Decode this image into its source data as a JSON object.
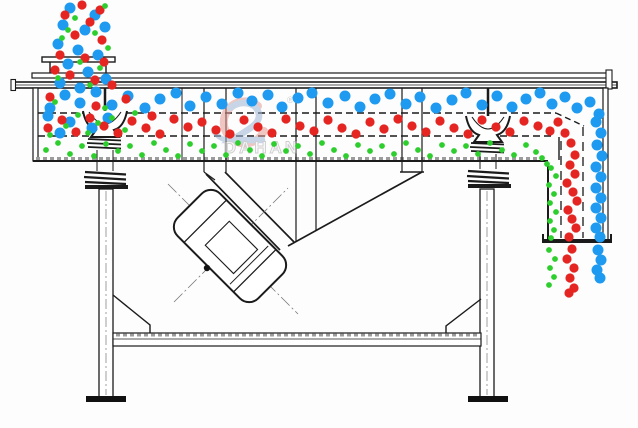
{
  "watermark": {
    "brand": "DAHAN",
    "registered": "®"
  },
  "colors": {
    "line": "#1b1b1b",
    "coarse_blue": "#1E9AF0",
    "medium_red": "#E42522",
    "fine_green": "#2FCE2F",
    "hatch_gray": "#9c9c9c",
    "watermark_gray": "#a8a8a8",
    "logo_red": "#E49A92",
    "logo_blue": "#9CB6D6"
  },
  "particles": {
    "coarse": {
      "color_key": "coarse_blue",
      "radius": 5.5,
      "points": [
        [
          70,
          8
        ],
        [
          95,
          15
        ],
        [
          63,
          25
        ],
        [
          85,
          30
        ],
        [
          105,
          27
        ],
        [
          58,
          44
        ],
        [
          78,
          50
        ],
        [
          98,
          55
        ],
        [
          68,
          64
        ],
        [
          88,
          72
        ],
        [
          106,
          79
        ],
        [
          60,
          83
        ],
        [
          80,
          88
        ],
        [
          50,
          108
        ],
        [
          65,
          95
        ],
        [
          80,
          103
        ],
        [
          96,
          92
        ],
        [
          112,
          105
        ],
        [
          128,
          96
        ],
        [
          145,
          108
        ],
        [
          160,
          99
        ],
        [
          176,
          93
        ],
        [
          190,
          106
        ],
        [
          206,
          97
        ],
        [
          222,
          104
        ],
        [
          238,
          93
        ],
        [
          252,
          101
        ],
        [
          268,
          95
        ],
        [
          282,
          107
        ],
        [
          298,
          98
        ],
        [
          312,
          93
        ],
        [
          328,
          103
        ],
        [
          345,
          96
        ],
        [
          360,
          107
        ],
        [
          375,
          99
        ],
        [
          390,
          94
        ],
        [
          406,
          104
        ],
        [
          420,
          97
        ],
        [
          436,
          108
        ],
        [
          452,
          100
        ],
        [
          466,
          93
        ],
        [
          482,
          105
        ],
        [
          497,
          96
        ],
        [
          512,
          107
        ],
        [
          526,
          99
        ],
        [
          540,
          93
        ],
        [
          552,
          104
        ],
        [
          565,
          97
        ],
        [
          577,
          108
        ],
        [
          48,
          116
        ],
        [
          70,
          122
        ],
        [
          92,
          128
        ],
        [
          60,
          133
        ],
        [
          108,
          118
        ],
        [
          590,
          102
        ],
        [
          599,
          114
        ],
        [
          596,
          122
        ],
        [
          601,
          133
        ],
        [
          597,
          145
        ],
        [
          602,
          156
        ],
        [
          596,
          167
        ],
        [
          601,
          177
        ],
        [
          596,
          188
        ],
        [
          601,
          198
        ],
        [
          596,
          208
        ],
        [
          601,
          218
        ],
        [
          596,
          228
        ],
        [
          600,
          237
        ],
        [
          598,
          250
        ],
        [
          601,
          260
        ],
        [
          597,
          270
        ],
        [
          600,
          278
        ]
      ]
    },
    "medium": {
      "color_key": "medium_red",
      "radius": 4.6,
      "points": [
        [
          82,
          5
        ],
        [
          100,
          10
        ],
        [
          65,
          15
        ],
        [
          90,
          22
        ],
        [
          75,
          35
        ],
        [
          102,
          40
        ],
        [
          60,
          55
        ],
        [
          85,
          58
        ],
        [
          104,
          62
        ],
        [
          70,
          75
        ],
        [
          95,
          80
        ],
        [
          112,
          85
        ],
        [
          55,
          70
        ],
        [
          48,
          128
        ],
        [
          62,
          120
        ],
        [
          76,
          132
        ],
        [
          90,
          118
        ],
        [
          104,
          126
        ],
        [
          118,
          133
        ],
        [
          132,
          121
        ],
        [
          146,
          128
        ],
        [
          160,
          134
        ],
        [
          174,
          119
        ],
        [
          188,
          127
        ],
        [
          202,
          122
        ],
        [
          216,
          130
        ],
        [
          230,
          134
        ],
        [
          244,
          120
        ],
        [
          258,
          127
        ],
        [
          272,
          133
        ],
        [
          286,
          119
        ],
        [
          300,
          126
        ],
        [
          314,
          131
        ],
        [
          328,
          120
        ],
        [
          342,
          128
        ],
        [
          356,
          134
        ],
        [
          370,
          122
        ],
        [
          384,
          129
        ],
        [
          398,
          119
        ],
        [
          412,
          126
        ],
        [
          426,
          132
        ],
        [
          440,
          121
        ],
        [
          454,
          128
        ],
        [
          468,
          134
        ],
        [
          482,
          120
        ],
        [
          496,
          127
        ],
        [
          510,
          132
        ],
        [
          524,
          121
        ],
        [
          538,
          126
        ],
        [
          550,
          131
        ],
        [
          50,
          97
        ],
        [
          96,
          106
        ],
        [
          126,
          99
        ],
        [
          152,
          116
        ],
        [
          558,
          122
        ],
        [
          565,
          133
        ],
        [
          571,
          143
        ],
        [
          575,
          155
        ],
        [
          570,
          165
        ],
        [
          575,
          174
        ],
        [
          567,
          183
        ],
        [
          573,
          192
        ],
        [
          577,
          201
        ],
        [
          568,
          210
        ],
        [
          572,
          219
        ],
        [
          576,
          228
        ],
        [
          569,
          237
        ],
        [
          572,
          249
        ],
        [
          567,
          259
        ],
        [
          574,
          268
        ],
        [
          570,
          278
        ],
        [
          574,
          288
        ],
        [
          569,
          293
        ]
      ]
    },
    "fine": {
      "color_key": "fine_green",
      "radius": 2.9,
      "points": [
        [
          105,
          6
        ],
        [
          75,
          18
        ],
        [
          95,
          33
        ],
        [
          62,
          38
        ],
        [
          108,
          48
        ],
        [
          80,
          62
        ],
        [
          100,
          68
        ],
        [
          58,
          78
        ],
        [
          90,
          85
        ],
        [
          68,
          30
        ],
        [
          46,
          150
        ],
        [
          58,
          143
        ],
        [
          70,
          154
        ],
        [
          82,
          146
        ],
        [
          94,
          156
        ],
        [
          106,
          144
        ],
        [
          118,
          151
        ],
        [
          130,
          146
        ],
        [
          142,
          155
        ],
        [
          154,
          143
        ],
        [
          166,
          150
        ],
        [
          178,
          156
        ],
        [
          190,
          144
        ],
        [
          202,
          151
        ],
        [
          214,
          146
        ],
        [
          226,
          155
        ],
        [
          238,
          143
        ],
        [
          250,
          150
        ],
        [
          262,
          156
        ],
        [
          274,
          144
        ],
        [
          286,
          151
        ],
        [
          298,
          146
        ],
        [
          310,
          154
        ],
        [
          322,
          143
        ],
        [
          334,
          150
        ],
        [
          346,
          156
        ],
        [
          358,
          145
        ],
        [
          370,
          151
        ],
        [
          382,
          146
        ],
        [
          394,
          154
        ],
        [
          406,
          143
        ],
        [
          418,
          150
        ],
        [
          430,
          156
        ],
        [
          442,
          145
        ],
        [
          454,
          151
        ],
        [
          466,
          146
        ],
        [
          478,
          154
        ],
        [
          490,
          143
        ],
        [
          502,
          150
        ],
        [
          514,
          155
        ],
        [
          526,
          145
        ],
        [
          536,
          152
        ],
        [
          55,
          102
        ],
        [
          78,
          115
        ],
        [
          98,
          123
        ],
        [
          66,
          126
        ],
        [
          88,
          133
        ],
        [
          112,
          118
        ],
        [
          50,
          135
        ],
        [
          105,
          108
        ],
        [
          125,
          130
        ],
        [
          135,
          113
        ],
        [
          542,
          158
        ],
        [
          547,
          164
        ],
        [
          551,
          168
        ],
        [
          556,
          176
        ],
        [
          549,
          185
        ],
        [
          554,
          194
        ],
        [
          550,
          203
        ],
        [
          556,
          212
        ],
        [
          550,
          221
        ],
        [
          554,
          230
        ],
        [
          551,
          238
        ],
        [
          549,
          250
        ],
        [
          555,
          259
        ],
        [
          550,
          268
        ],
        [
          554,
          277
        ],
        [
          549,
          285
        ]
      ]
    }
  }
}
